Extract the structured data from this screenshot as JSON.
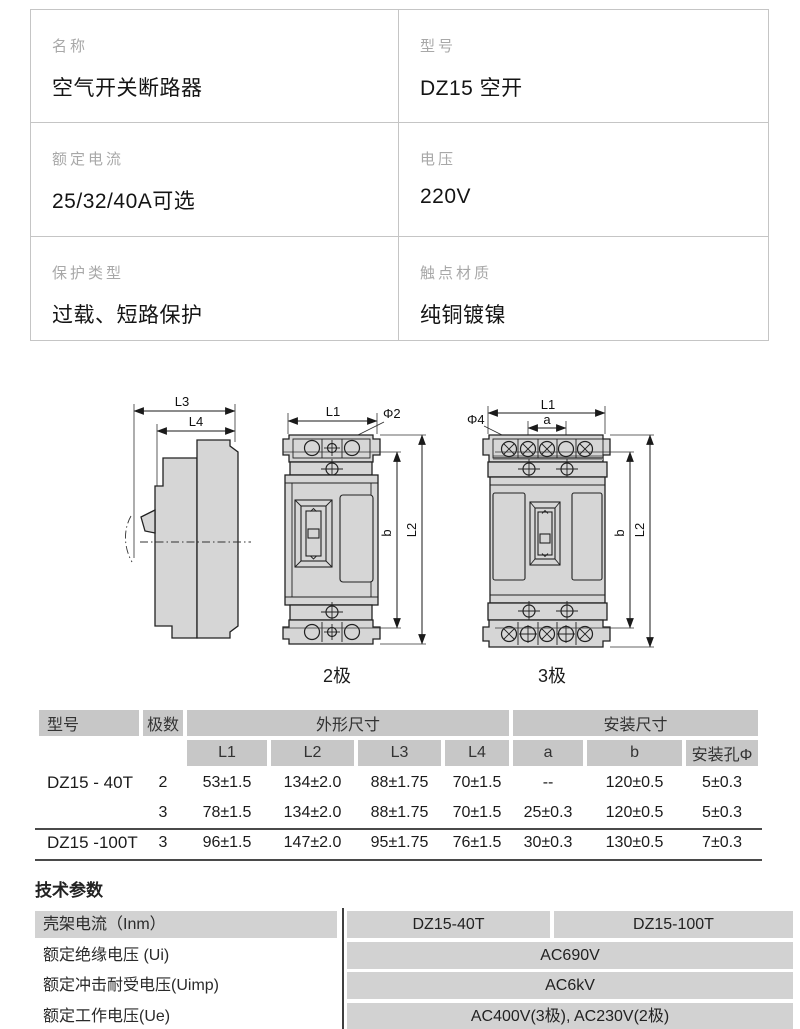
{
  "spec_table": {
    "cells": [
      {
        "label": "名称",
        "value": "空气开关断路器"
      },
      {
        "label": "型号",
        "value": "DZ15 空开"
      },
      {
        "label": "额定电流",
        "value": "25/32/40A可选"
      },
      {
        "label": "电压",
        "value": "220V"
      },
      {
        "label": "保护类型",
        "value": "过载、短路保护"
      },
      {
        "label": "触点材质",
        "value": "纯铜镀镍"
      }
    ]
  },
  "drawings": {
    "side": {
      "l3": "L3",
      "l4": "L4"
    },
    "pole2": {
      "l1": "L1",
      "phi": "Φ2",
      "b": "b",
      "l2": "L2",
      "caption": "2极"
    },
    "pole3": {
      "l1": "L1",
      "a": "a",
      "phi": "Φ4",
      "b": "b",
      "l2": "L2",
      "caption": "3极"
    }
  },
  "dimension_table": {
    "header_groups": {
      "model": "型号",
      "poles": "极数",
      "outline": "外形尺寸",
      "mounting": "安装尺寸"
    },
    "columns": [
      "L1",
      "L2",
      "L3",
      "L4",
      "a",
      "b",
      "安装孔Φ"
    ],
    "rows": [
      {
        "model": "DZ15 - 40T",
        "poles": "2",
        "values": [
          "53±1.5",
          "134±2.0",
          "88±1.75",
          "70±1.5",
          "--",
          "120±0.5",
          "5±0.3"
        ]
      },
      {
        "model": "",
        "poles": "3",
        "values": [
          "78±1.5",
          "134±2.0",
          "88±1.75",
          "70±1.5",
          "25±0.3",
          "120±0.5",
          "5±0.3"
        ]
      },
      {
        "model": "DZ15 -100T",
        "poles": "3",
        "values": [
          "96±1.5",
          "147±2.0",
          "95±1.75",
          "76±1.5",
          "30±0.3",
          "130±0.5",
          "7±0.3"
        ]
      }
    ]
  },
  "tech_params": {
    "title": "技术参数",
    "rows": [
      {
        "label": "壳架电流（Inm）",
        "values": [
          "DZ15-40T",
          "DZ15-100T"
        ]
      },
      {
        "label": "额定绝缘电压 (Ui)",
        "values": [
          "AC690V"
        ]
      },
      {
        "label": "额定冲击耐受电压(Uimp)",
        "values": [
          "AC6kV"
        ]
      },
      {
        "label": "额定工作电压(Ue)",
        "values": [
          "AC400V(3极), AC230V(2极)"
        ]
      }
    ]
  },
  "colors": {
    "table_border": "#c5c5c5",
    "header_cell_bg": "#c7c7c7",
    "param_cell_bg": "#d2d2d2",
    "label_text": "#a8a8a8",
    "dark_rule": "#4a4a4a",
    "drawing_fill": "#d6d6d6"
  }
}
